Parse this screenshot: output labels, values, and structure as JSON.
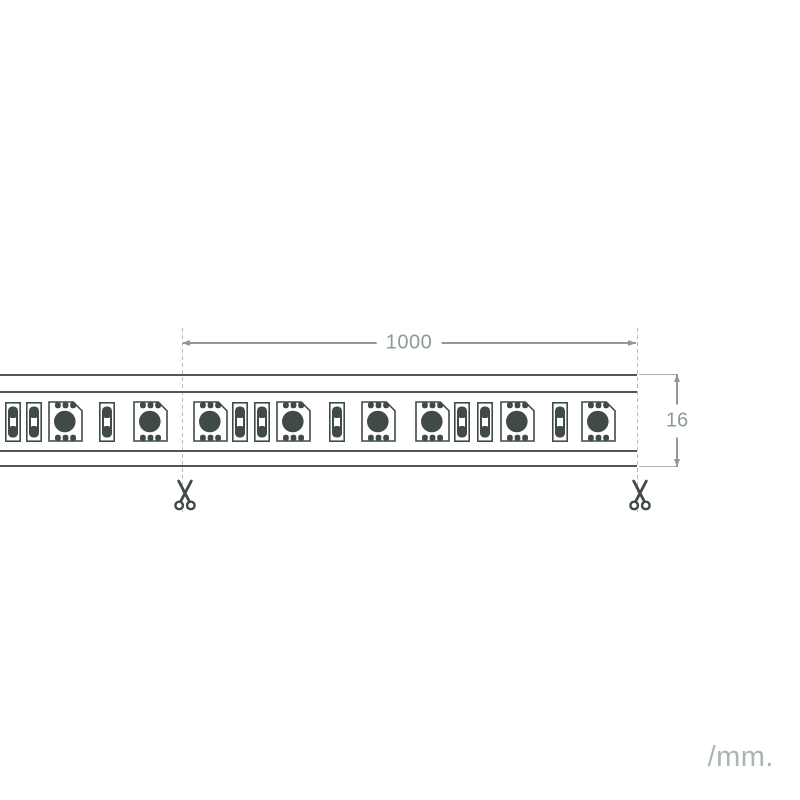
{
  "diagram": {
    "title": "led-strip-dimension-diagram",
    "unit_label": "/mm.",
    "colors": {
      "component": "#404b48",
      "strip_line": "#4d5855",
      "dimension": "#8c9b96",
      "dashed": "#b4bfbb",
      "unit_text": "#a9b6b2"
    },
    "strip": {
      "left": 0,
      "right": 637,
      "top": 374,
      "bottom": 467,
      "components": [
        {
          "type": "resistor",
          "cx": 13
        },
        {
          "type": "resistor",
          "cx": 34
        },
        {
          "type": "led",
          "cx": 65
        },
        {
          "type": "resistor",
          "cx": 107
        },
        {
          "type": "led",
          "cx": 150
        },
        {
          "type": "led",
          "cx": 210
        },
        {
          "type": "resistor",
          "cx": 240
        },
        {
          "type": "resistor",
          "cx": 262
        },
        {
          "type": "led",
          "cx": 293
        },
        {
          "type": "resistor",
          "cx": 337
        },
        {
          "type": "led",
          "cx": 378
        },
        {
          "type": "led",
          "cx": 432
        },
        {
          "type": "resistor",
          "cx": 462
        },
        {
          "type": "resistor",
          "cx": 485
        },
        {
          "type": "led",
          "cx": 517
        },
        {
          "type": "resistor",
          "cx": 560
        },
        {
          "type": "led",
          "cx": 598
        }
      ]
    },
    "dimensions": {
      "length": {
        "label": "1000"
      },
      "height": {
        "label": "16"
      }
    },
    "cut_marks": [
      {
        "x": 182
      },
      {
        "x": 637
      }
    ]
  }
}
